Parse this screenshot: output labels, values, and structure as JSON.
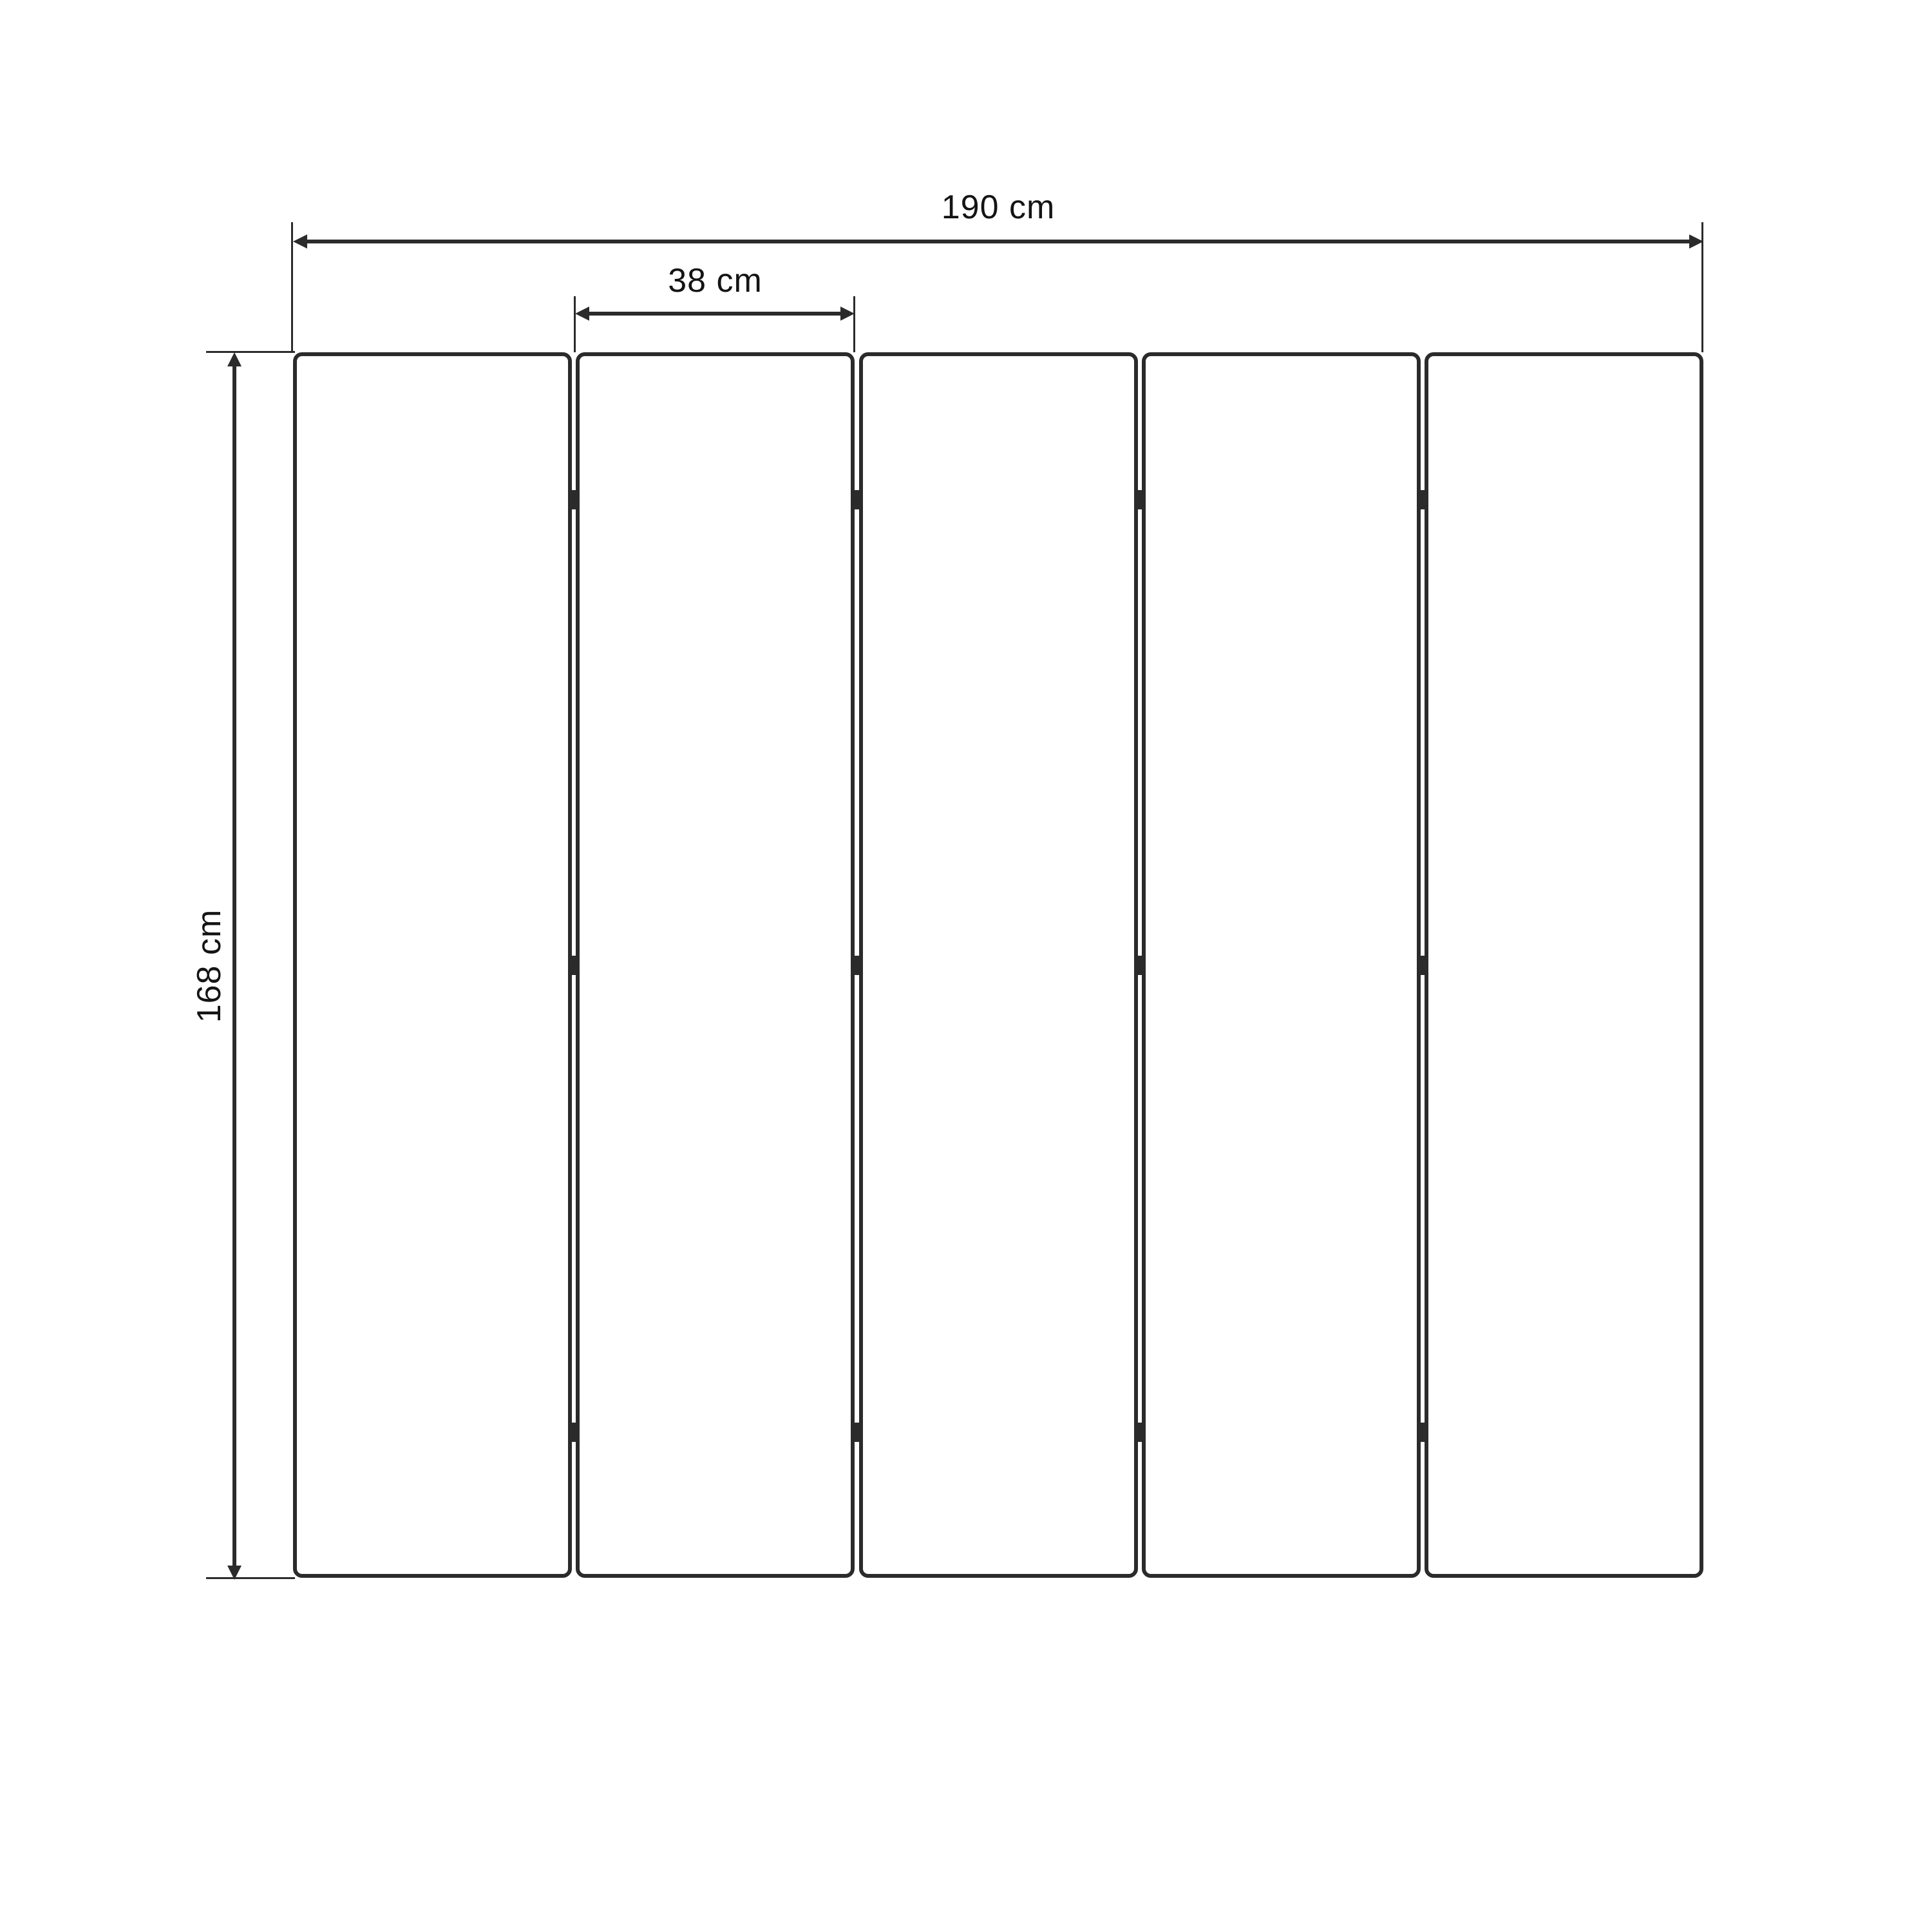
{
  "diagram": {
    "type": "dimension-drawing",
    "subject": "five-panel folding screen front view",
    "panels": {
      "count": 5,
      "gaps": 4,
      "hinges_per_gap": 3
    },
    "dimensions": {
      "total_width": {
        "label": "190 cm"
      },
      "panel_width": {
        "label": "38 cm"
      },
      "height": {
        "label": "168 cm"
      }
    },
    "colors": {
      "line": "#2b2b2b",
      "text": "#141414",
      "background": "#ffffff"
    }
  }
}
